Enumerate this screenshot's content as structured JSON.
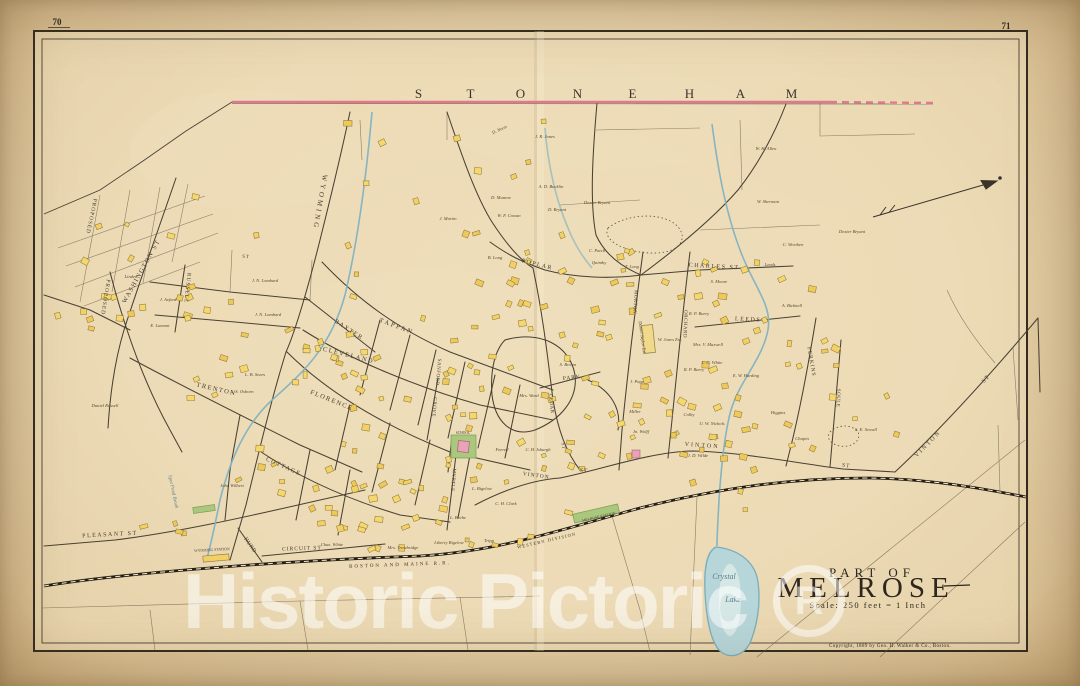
{
  "page": {
    "left_number": "70",
    "right_number": "71"
  },
  "boundary": {
    "town": "STONEHAM",
    "letter_xs": [
      419,
      471,
      521,
      578,
      633,
      690,
      741,
      792
    ],
    "letters_y": 98,
    "line_color": "#e0798f"
  },
  "title_block": {
    "line1": "PART OF",
    "line2": "MELROSE",
    "scale": "Scale: 250 feet = 1 Inch",
    "copyright": "Copyright, 1889 by Geo. H. Walker & Co., Boston."
  },
  "watermark": {
    "text": "Historic Pictoric",
    "registered_mark": "R"
  },
  "water": {
    "labels": [
      {
        "t": "Crystal",
        "x": 724,
        "y": 579,
        "s": 8
      },
      {
        "t": "Lake",
        "x": 733,
        "y": 602,
        "s": 8
      },
      {
        "t": "Spot Pond Brook",
        "x": 172,
        "y": 492,
        "r": 78,
        "s": 5
      }
    ]
  },
  "railroad": {
    "labels": [
      {
        "t": "BOSTON  AND  MAINE  R.R.",
        "x": 400,
        "y": 566,
        "r": -2,
        "s": 5,
        "sp": 2
      },
      {
        "t": "WESTERN DIVISION",
        "x": 547,
        "y": 542,
        "r": -13,
        "s": 4.4,
        "sp": 1.2
      }
    ],
    "stations": [
      {
        "t": "WYOMING STATION",
        "x": 212,
        "y": 551,
        "r": -3,
        "s": 3.8
      },
      {
        "t": "MELROSE STATION",
        "x": 599,
        "y": 518,
        "r": -13,
        "s": 3.8
      }
    ]
  },
  "landmarks": {
    "school_label": "SCHOOL"
  },
  "streets": [
    {
      "t": "WYOMING",
      "x": 318,
      "y": 202,
      "r": 100,
      "s": 7,
      "sp": 3
    },
    {
      "t": "WASHINGTON  ST",
      "x": 143,
      "y": 272,
      "r": -61,
      "s": 6.5,
      "sp": 1.5
    },
    {
      "t": "PROPOSED",
      "x": 90,
      "y": 216,
      "r": 102,
      "s": 5.5,
      "sp": 1
    },
    {
      "t": "PROPOSED",
      "x": 104,
      "y": 297,
      "r": 99,
      "s": 5.5,
      "sp": 1
    },
    {
      "t": "RUSSELL",
      "x": 186,
      "y": 288,
      "r": 96,
      "s": 5.5,
      "sp": 1
    },
    {
      "t": "ST",
      "x": 246,
      "y": 258,
      "r": 4,
      "s": 5,
      "sp": 1
    },
    {
      "t": "BAXTER",
      "x": 348,
      "y": 331,
      "r": 33,
      "s": 6,
      "sp": 1.5
    },
    {
      "t": "TAPPAN",
      "x": 396,
      "y": 328,
      "r": 20,
      "s": 6.5,
      "sp": 2
    },
    {
      "t": "CLEVELAND",
      "x": 348,
      "y": 357,
      "r": 14,
      "s": 6.5,
      "sp": 1.5
    },
    {
      "t": "FLORENCE",
      "x": 331,
      "y": 402,
      "r": 22,
      "s": 6.5,
      "sp": 1.5
    },
    {
      "t": "SANFORD",
      "x": 437,
      "y": 372,
      "r": 95,
      "s": 5,
      "sp": 0.5
    },
    {
      "t": "TRENTON",
      "x": 216,
      "y": 391,
      "r": 13,
      "s": 6.5,
      "sp": 1.5
    },
    {
      "t": "COTTAGE",
      "x": 283,
      "y": 468,
      "r": 24,
      "s": 6,
      "sp": 1.5
    },
    {
      "t": "PLEASANT  ST",
      "x": 110,
      "y": 536,
      "r": -3,
      "s": 6,
      "sp": 1.5
    },
    {
      "t": "HURD",
      "x": 249,
      "y": 546,
      "r": 55,
      "s": 5.5,
      "sp": 0.5
    },
    {
      "t": "CIRCUIT  ST",
      "x": 302,
      "y": 550,
      "r": -2,
      "s": 5.5,
      "sp": 1
    },
    {
      "t": "POPLAR",
      "x": 537,
      "y": 266,
      "r": 14,
      "s": 6,
      "sp": 1.5
    },
    {
      "t": "CHARLES  ST",
      "x": 714,
      "y": 268,
      "r": 3,
      "s": 6,
      "sp": 1.5
    },
    {
      "t": "MORTON",
      "x": 634,
      "y": 302,
      "r": 94,
      "s": 5,
      "sp": 0.5
    },
    {
      "t": "ORCHARD",
      "x": 684,
      "y": 324,
      "r": 92,
      "s": 5,
      "sp": 0.5
    },
    {
      "t": "LEEDS",
      "x": 748,
      "y": 321,
      "r": 3,
      "s": 6,
      "sp": 1.5
    },
    {
      "t": "PERKINS",
      "x": 810,
      "y": 362,
      "r": 80,
      "s": 5.5,
      "sp": 1
    },
    {
      "t": "SOULE",
      "x": 837,
      "y": 398,
      "r": 92,
      "s": 5,
      "sp": 0.5
    },
    {
      "t": "MYRTLE",
      "x": 452,
      "y": 480,
      "r": 95,
      "s": 5,
      "sp": 0.5
    },
    {
      "t": "GROVE",
      "x": 433,
      "y": 407,
      "r": 95,
      "s": 5,
      "sp": 0.5
    },
    {
      "t": "PARK",
      "x": 572,
      "y": 379,
      "r": -6,
      "s": 5.5,
      "sp": 1
    },
    {
      "t": "CEDAR",
      "x": 550,
      "y": 404,
      "r": 84,
      "s": 5,
      "sp": 0.5
    },
    {
      "t": "ST",
      "x": 562,
      "y": 446,
      "r": 84,
      "s": 5,
      "sp": 0.5
    },
    {
      "t": "VINTON",
      "x": 536,
      "y": 477,
      "r": 8,
      "s": 5.5,
      "sp": 1
    },
    {
      "t": "ST",
      "x": 584,
      "y": 472,
      "r": 5,
      "s": 5.5,
      "sp": 1
    },
    {
      "t": "VINTON",
      "x": 702,
      "y": 447,
      "r": 4,
      "s": 6,
      "sp": 2
    },
    {
      "t": "ST",
      "x": 846,
      "y": 467,
      "r": 8,
      "s": 5.5,
      "sp": 1
    },
    {
      "t": "VINTON",
      "x": 929,
      "y": 445,
      "r": -46,
      "s": 6,
      "sp": 2
    },
    {
      "t": "ST",
      "x": 987,
      "y": 380,
      "r": -46,
      "s": 6,
      "sp": 1
    }
  ],
  "owners": [
    {
      "t": "J. R. Jones",
      "x": 545,
      "y": 138
    },
    {
      "t": "D. Noon",
      "x": 500,
      "y": 131,
      "r": -25
    },
    {
      "t": "A. D. Bucklin",
      "x": 551,
      "y": 188
    },
    {
      "t": "D. Munroe",
      "x": 501,
      "y": 199
    },
    {
      "t": "W. F. Cowan",
      "x": 509,
      "y": 217
    },
    {
      "t": "D. Bryant",
      "x": 557,
      "y": 211
    },
    {
      "t": "Dexter Bryant",
      "x": 597,
      "y": 204
    },
    {
      "t": "J. Martin",
      "x": 448,
      "y": 220
    },
    {
      "t": "B. Long",
      "x": 495,
      "y": 259
    },
    {
      "t": "W. H. Allen",
      "x": 766,
      "y": 150
    },
    {
      "t": "W. Sherman",
      "x": 768,
      "y": 203
    },
    {
      "t": "Dexter Bryant",
      "x": 852,
      "y": 233
    },
    {
      "t": "C. Worthen",
      "x": 793,
      "y": 246
    },
    {
      "t": "Leeds",
      "x": 770,
      "y": 266
    },
    {
      "t": "A. Bicknell",
      "x": 792,
      "y": 307
    },
    {
      "t": "J. N. Lombard",
      "x": 265,
      "y": 282
    },
    {
      "t": "J. N. Lombard",
      "x": 268,
      "y": 316
    },
    {
      "t": "J. Axford",
      "x": 168,
      "y": 301
    },
    {
      "t": "E. Lamont",
      "x": 160,
      "y": 327
    },
    {
      "t": "Linden",
      "x": 131,
      "y": 278
    },
    {
      "t": "Daniel Russell",
      "x": 105,
      "y": 407
    },
    {
      "t": "L. B. Sears",
      "x": 255,
      "y": 376
    },
    {
      "t": "L. S. Osborn",
      "x": 242,
      "y": 393
    },
    {
      "t": "John Wilbert",
      "x": 232,
      "y": 487
    },
    {
      "t": "C. Patch",
      "x": 597,
      "y": 252
    },
    {
      "t": "Quimby",
      "x": 599,
      "y": 264
    },
    {
      "t": "T. Long",
      "x": 632,
      "y": 268
    },
    {
      "t": "S. Moore",
      "x": 719,
      "y": 283
    },
    {
      "t": "Daniel Taylor Est.",
      "x": 641,
      "y": 338,
      "r": 82
    },
    {
      "t": "W. Jones Est.",
      "x": 670,
      "y": 341
    },
    {
      "t": "Mrs. V. Maxwell",
      "x": 708,
      "y": 346
    },
    {
      "t": "L. C. White",
      "x": 712,
      "y": 364
    },
    {
      "t": "E. W. Harding",
      "x": 746,
      "y": 377
    },
    {
      "t": "R. P. Barry",
      "x": 699,
      "y": 315
    },
    {
      "t": "R. P. Barry",
      "x": 694,
      "y": 371
    },
    {
      "t": "Mrs. Ward",
      "x": 529,
      "y": 397
    },
    {
      "t": "S. Brown",
      "x": 568,
      "y": 366
    },
    {
      "t": "J. Page",
      "x": 637,
      "y": 383
    },
    {
      "t": "Miller",
      "x": 635,
      "y": 413
    },
    {
      "t": "Jn. Wolff",
      "x": 641,
      "y": 433
    },
    {
      "t": "Colby",
      "x": 689,
      "y": 416
    },
    {
      "t": "U. W. Nichols",
      "x": 712,
      "y": 425
    },
    {
      "t": "Higgins",
      "x": 778,
      "y": 414
    },
    {
      "t": "Chapin",
      "x": 802,
      "y": 440
    },
    {
      "t": "S. E. Sewall",
      "x": 866,
      "y": 431
    },
    {
      "t": "C. H. Isburgh",
      "x": 538,
      "y": 451
    },
    {
      "t": "Farrell",
      "x": 502,
      "y": 451
    },
    {
      "t": "L. Bigelow",
      "x": 482,
      "y": 490
    },
    {
      "t": "J. D. Wilde",
      "x": 698,
      "y": 457
    },
    {
      "t": "L. Beebe",
      "x": 458,
      "y": 519
    },
    {
      "t": "Liberty Bigelow",
      "x": 449,
      "y": 544
    },
    {
      "t": "Mrs. Trowbridge",
      "x": 403,
      "y": 549
    },
    {
      "t": "Chas. White",
      "x": 332,
      "y": 546
    },
    {
      "t": "Tripp",
      "x": 489,
      "y": 542
    },
    {
      "t": "C. H. Clark",
      "x": 506,
      "y": 505
    }
  ],
  "building_clusters": [
    {
      "x": 345,
      "y": 118,
      "w": 240,
      "h": 85,
      "n": 9
    },
    {
      "x": 60,
      "y": 195,
      "w": 215,
      "h": 125,
      "n": 14
    },
    {
      "x": 105,
      "y": 255,
      "w": 150,
      "h": 145,
      "n": 12
    },
    {
      "x": 285,
      "y": 245,
      "w": 75,
      "h": 190,
      "n": 11
    },
    {
      "x": 305,
      "y": 300,
      "w": 245,
      "h": 105,
      "n": 30
    },
    {
      "x": 235,
      "y": 405,
      "w": 255,
      "h": 130,
      "n": 30
    },
    {
      "x": 465,
      "y": 232,
      "w": 190,
      "h": 55,
      "n": 13
    },
    {
      "x": 595,
      "y": 240,
      "w": 220,
      "h": 85,
      "n": 22
    },
    {
      "x": 625,
      "y": 330,
      "w": 215,
      "h": 130,
      "n": 32
    },
    {
      "x": 520,
      "y": 305,
      "w": 105,
      "h": 150,
      "n": 14
    },
    {
      "x": 565,
      "y": 432,
      "w": 245,
      "h": 85,
      "n": 18
    },
    {
      "x": 395,
      "y": 432,
      "w": 150,
      "h": 115,
      "n": 16
    },
    {
      "x": 280,
      "y": 482,
      "w": 170,
      "h": 75,
      "n": 12
    },
    {
      "x": 825,
      "y": 365,
      "w": 100,
      "h": 70,
      "n": 3
    },
    {
      "x": 115,
      "y": 508,
      "w": 115,
      "h": 38,
      "n": 4
    },
    {
      "x": 55,
      "y": 290,
      "w": 60,
      "h": 40,
      "n": 5
    }
  ],
  "colors": {
    "paper": "#ecd9b4",
    "building_yellow": "#f2d063",
    "boundary_pink": "#e0798f",
    "water_blue": "#7fb2c2",
    "green_lot": "#a9c87d",
    "school_pink": "#e9a2b6",
    "line_ink": "#4a4134"
  }
}
